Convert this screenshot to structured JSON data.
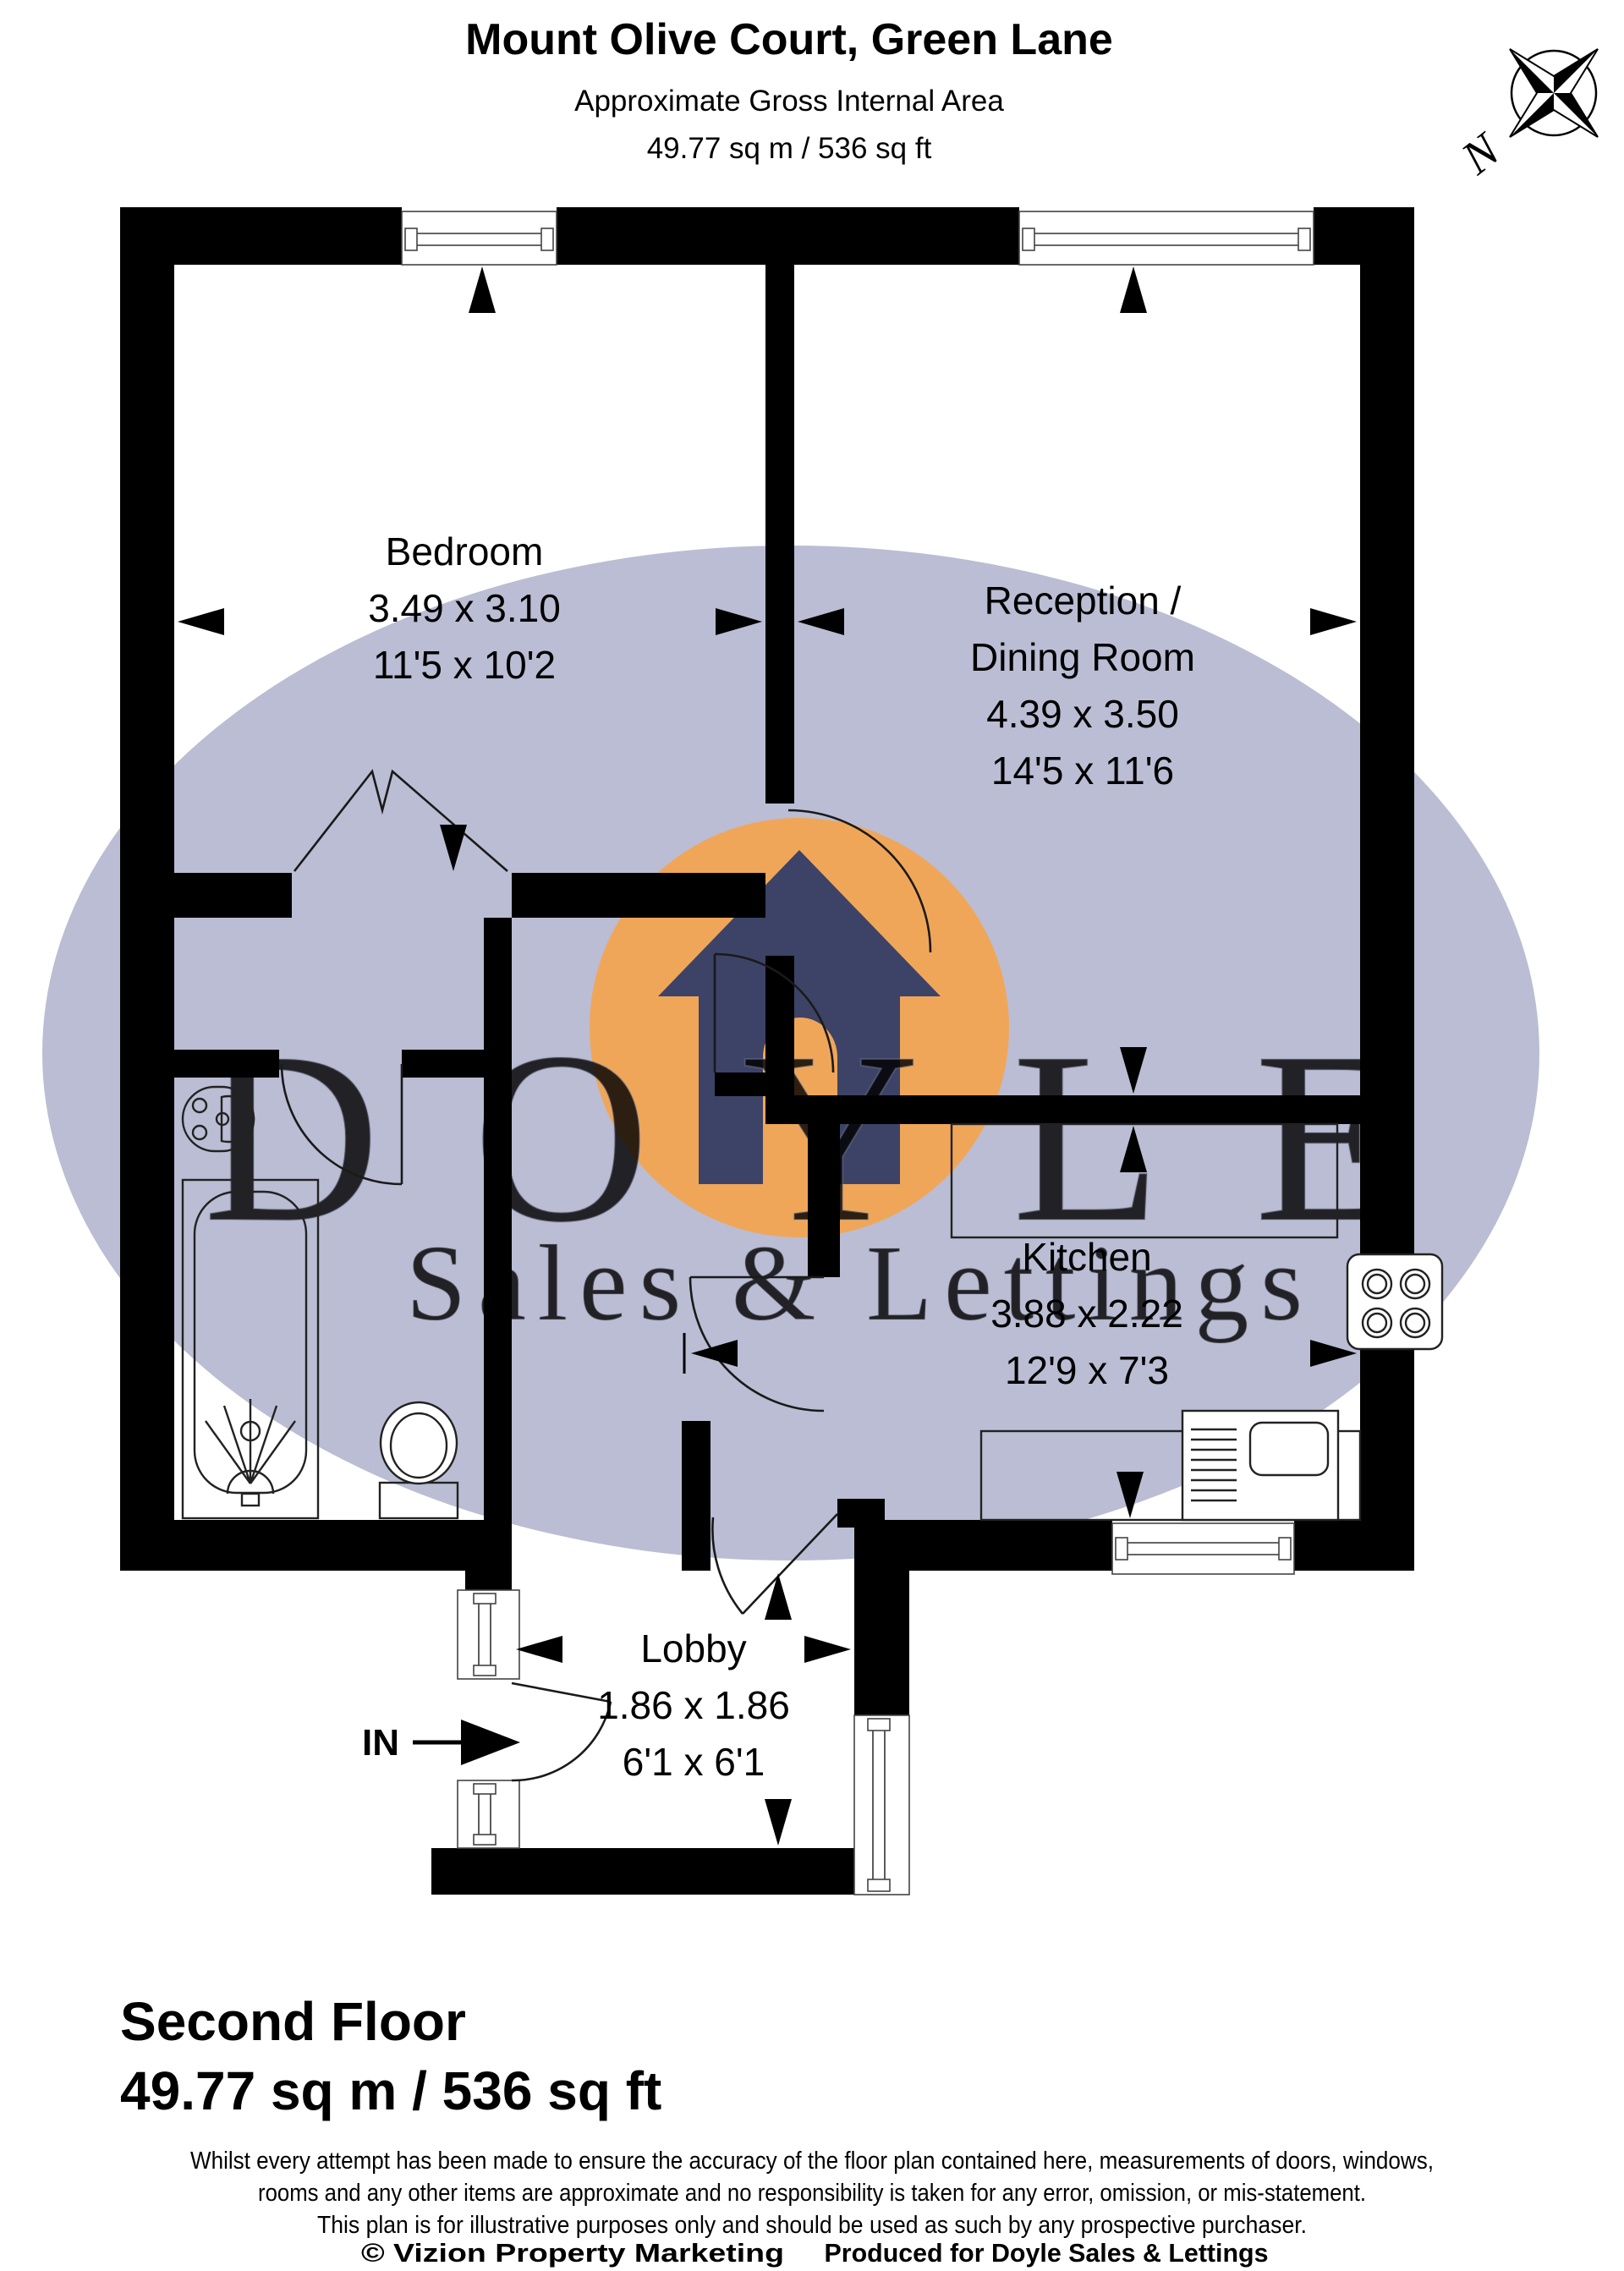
{
  "header": {
    "title": "Mount Olive Court, Green Lane",
    "subtitle1": "Approximate Gross Internal Area",
    "subtitle2": "49.77 sq m / 536 sq ft"
  },
  "compass": {
    "north_label": "N"
  },
  "watermark": {
    "brand": "DOYLE",
    "tagline": "Sales & Lettings"
  },
  "plan": {
    "entrance_label": "IN",
    "rooms": [
      {
        "id": "bedroom",
        "name": "Bedroom",
        "dim_m": "3.49 x 3.10",
        "dim_ft": "11'5 x 10'2"
      },
      {
        "id": "reception",
        "name": "Reception /",
        "name2": "Dining Room",
        "dim_m": "4.39 x 3.50",
        "dim_ft": "14'5 x 11'6"
      },
      {
        "id": "kitchen",
        "name": "Kitchen",
        "dim_m": "3.88 x 2.22",
        "dim_ft": "12'9 x 7'3"
      },
      {
        "id": "lobby",
        "name": "Lobby",
        "dim_m": "1.86 x 1.86",
        "dim_ft": "6'1 x 6'1"
      }
    ]
  },
  "footer": {
    "floor": "Second Floor",
    "area": "49.77 sq m / 536 sq ft"
  },
  "disclaimer": {
    "line1": "Whilst every attempt has been made to ensure the accuracy of the floor plan contained here, measurements of doors, windows,",
    "line2": "rooms and any other items are approximate and no responsibility is taken for any error, omission, or mis-statement.",
    "line3": "This plan is for illustrative purposes only and should be used as such by any prospective purchaser."
  },
  "credits": {
    "left": "© Vizion Property Marketing",
    "right": "Produced for Doyle Sales & Lettings"
  },
  "colors": {
    "wall": "#000000",
    "watermark_fill": "#b2b6ce",
    "logo_orange": "#f0a659",
    "logo_house": "#3d4366",
    "watermark_text": "#f3f4fa"
  }
}
